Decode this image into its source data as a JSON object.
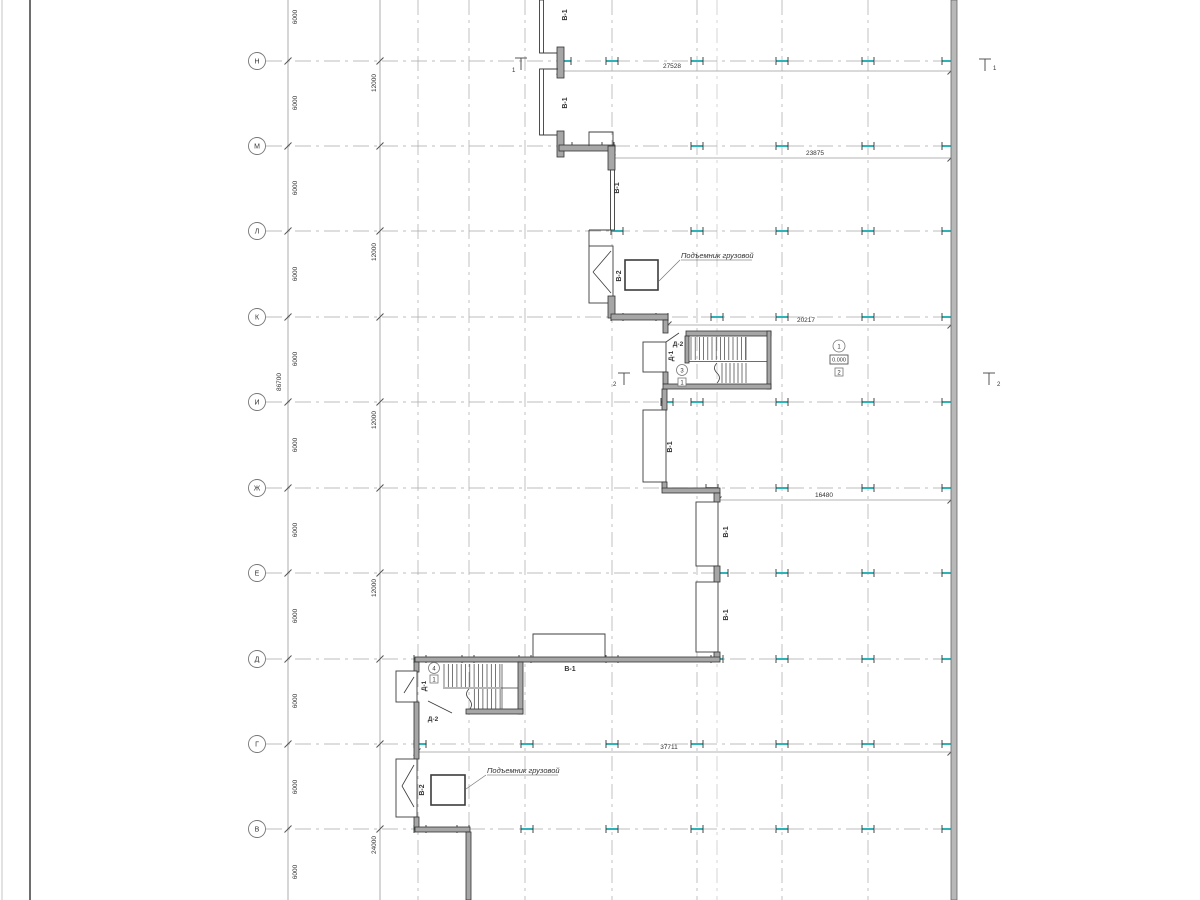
{
  "axes": {
    "rows": [
      {
        "label": "Н"
      },
      {
        "label": "М"
      },
      {
        "label": "Л"
      },
      {
        "label": "К"
      },
      {
        "label": "И"
      },
      {
        "label": "Ж"
      },
      {
        "label": "Е"
      },
      {
        "label": "Д"
      },
      {
        "label": "Г"
      },
      {
        "label": "В"
      }
    ]
  },
  "dims": {
    "overall": "86700",
    "bay": "6000",
    "double_bay": "12000",
    "quad_bay": "24000",
    "h": [
      {
        "value": "27528"
      },
      {
        "value": "23875"
      },
      {
        "value": "20217"
      },
      {
        "value": "16480"
      },
      {
        "value": "37711"
      }
    ]
  },
  "labels": {
    "v1": "В-1",
    "v2": "В-2",
    "d1": "Д-1",
    "d2": "Д-2"
  },
  "ann": {
    "hoist": "Подъемник грузовой",
    "level": "0.000"
  },
  "marks": {
    "s1": "1",
    "s2": "2",
    "c3": "3",
    "c4": "4",
    "b3": "1",
    "b4": "1",
    "lvl_circle": "1",
    "lvl_badge": "2"
  },
  "colors": {
    "column_tick": "#2fb3b8",
    "wall_fill": "#a6a6a6",
    "grid": "#a8a8a8"
  }
}
